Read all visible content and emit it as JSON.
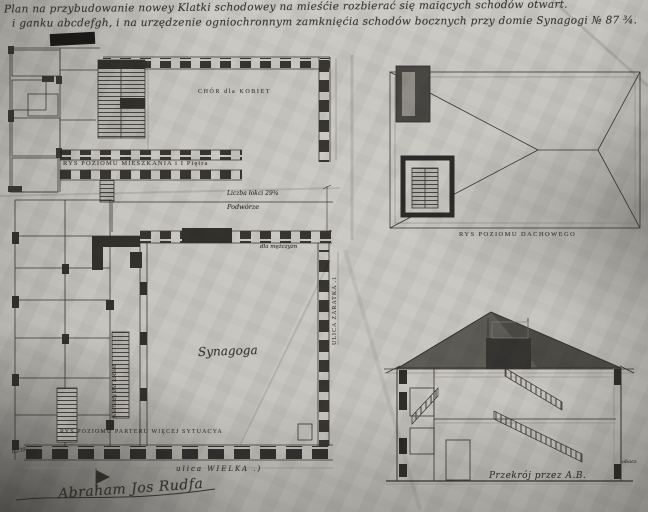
{
  "drawing": {
    "title_line1": "Plan na przybudowanie nowey Klatki schodowey na mieśćie rozbierać się maiących schodów otwart.",
    "title_line2": "i ganku abcdefgh, i na urzędzenie ogniochronnym zamknięćia schodów bocznych przy domie Synagogi № 87 ¾.",
    "labels": {
      "first_floor_plan": "RYS POZIOMU MIESZKANIA i I Piętra",
      "choir": "CHÓR dla KOBIET",
      "cubits": "Liczba łokci 29¾",
      "courtyard": "Podwórze",
      "for_men": "dla mężczyzn",
      "synagogue": "Synagoga",
      "stairs_note": "wschody dla kobiet",
      "street_side": "ULICA ZARATKA .1",
      "ground_plan": "RYS POZIOMU PARTERU WIĘCEJ SYTUACYA",
      "street_bottom": "ulica WIELKA .)",
      "roof_plan": "RYS POZIOMU DACHOWEGO",
      "section": "Przekrój przez A.B.",
      "see_note": "obacz",
      "file_number": "6239.",
      "signature": "Abraham Jos Rudfa"
    },
    "colors": {
      "paper": "#c6c4be",
      "ink": "#2b2823",
      "pencil": "#85817a",
      "roof_fill": "#504e49"
    }
  }
}
